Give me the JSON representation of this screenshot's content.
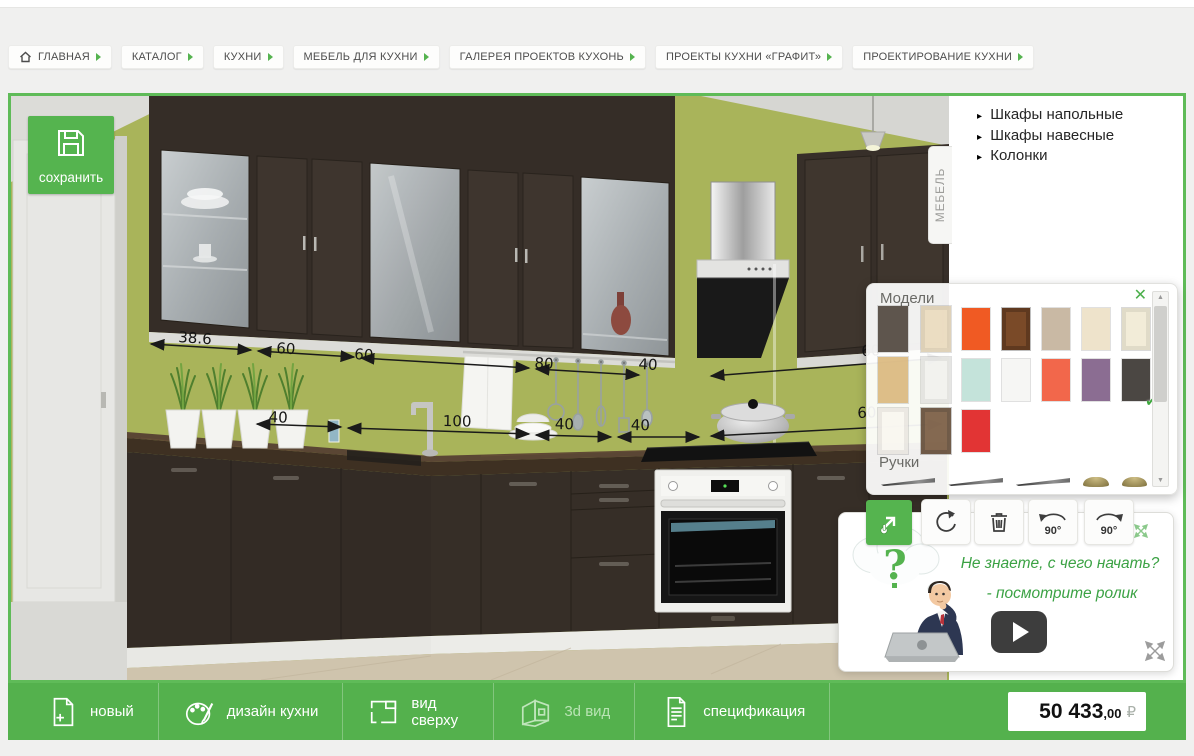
{
  "app": {
    "type": "kitchen-3d-planner"
  },
  "colors": {
    "accent_green": "#55b44f",
    "toolbar_green": "#54b14d",
    "wall_olive": "#a9b45a",
    "cabinet_dark": "#38302a",
    "help_text_green": "#3ba244"
  },
  "breadcrumbs": {
    "items": [
      {
        "label": "ГЛАВНАЯ",
        "home": true
      },
      {
        "label": "КАТАЛОГ"
      },
      {
        "label": "КУХНИ"
      },
      {
        "label": "МЕБЕЛЬ ДЛЯ КУХНИ"
      },
      {
        "label": "ГАЛЕРЕЯ ПРОЕКТОВ КУХОНЬ"
      },
      {
        "label": "ПРОЕКТЫ КУХНИ «ГРАФИТ»"
      },
      {
        "label": "ПРОЕКТИРОВАНИЕ КУХНИ"
      }
    ]
  },
  "save_button": {
    "label": "сохранить"
  },
  "furniture_tab": {
    "label": "МЕБЕЛЬ"
  },
  "catalog_menu": {
    "bullet": "▸",
    "items": [
      {
        "label": "Шкафы напольные"
      },
      {
        "label": "Шкафы навесные"
      },
      {
        "label": "Колонки"
      }
    ]
  },
  "scene": {
    "dimension_labels": [
      {
        "text": "38.6",
        "x": "168px",
        "y": "232px",
        "rot": "rotate(4deg)"
      },
      {
        "text": "60",
        "x": "266px",
        "y": "243px",
        "rot": "rotate(4deg)"
      },
      {
        "text": "60",
        "x": "344px",
        "y": "249px",
        "rot": "rotate(4deg)"
      },
      {
        "text": "80",
        "x": "524px",
        "y": "258px",
        "rot": "rotate(3deg)"
      },
      {
        "text": "40",
        "x": "628px",
        "y": "259px",
        "rot": "rotate(3deg)"
      },
      {
        "text": "60",
        "x": "850px",
        "y": "246px",
        "rot": "rotate(-2deg)"
      },
      {
        "text": "40",
        "x": "258px",
        "y": "312px",
        "rot": "rotate(2deg)"
      },
      {
        "text": "100",
        "x": "432px",
        "y": "316px",
        "rot": "rotate(1deg)"
      },
      {
        "text": "40",
        "x": "544px",
        "y": "319px",
        "rot": "rotate(1deg)"
      },
      {
        "text": "40",
        "x": "620px",
        "y": "320px",
        "rot": "rotate(1deg)"
      },
      {
        "text": "60",
        "x": "846px",
        "y": "308px",
        "rot": "rotate(-2deg)"
      }
    ]
  },
  "models_panel": {
    "title": "Модели",
    "handles_title": "Ручки",
    "close_icon": "✕",
    "scroll_up": "▲",
    "scroll_down": "▼",
    "selected_check": "✔",
    "thumbnails": [
      {
        "name": "front-dark-brown",
        "color": "#3f342a"
      },
      {
        "name": "front-cream-frame",
        "color": "#ead9b8",
        "cls": "tx-door-light"
      },
      {
        "name": "front-light-wood",
        "color": "#d8b271",
        "cls": "tx-wood"
      },
      {
        "name": "front-white",
        "color": "#f1f1ee",
        "cls": "tx-door-light"
      },
      {
        "name": "front-white-sketch",
        "color": "#faf7f0",
        "cls": "tx-door-light"
      },
      {
        "name": "front-brown-door",
        "color": "#6b4a2e",
        "cls": "tx-door"
      }
    ],
    "swatches": [
      {
        "name": "orange",
        "color": "#f05a23"
      },
      {
        "name": "brown-wood-door",
        "color": "#7a4a28",
        "cls": "tx-door"
      },
      {
        "name": "taupe",
        "color": "#c9b9a4"
      },
      {
        "name": "cream",
        "color": "#eee3cb"
      },
      {
        "name": "cream-panel-door",
        "color": "#f2ecd8",
        "cls": "tx-door-light"
      },
      {
        "name": "mint-planks",
        "color": "#c4e3da",
        "cls": "tx-stripes"
      },
      {
        "name": "white",
        "color": "#f6f6f4"
      },
      {
        "name": "coral",
        "color": "#f2674b"
      },
      {
        "name": "purple",
        "color": "#8b6d92"
      },
      {
        "name": "graphite",
        "color": "#4b4743",
        "selected": true
      },
      {
        "name": "red",
        "color": "#e23434"
      }
    ],
    "handles": [
      {
        "name": "long-handle",
        "cls": "handle-long"
      },
      {
        "name": "long-handle",
        "cls": "handle-long"
      },
      {
        "name": "long-handle",
        "cls": "handle-long"
      },
      {
        "name": "knob",
        "cls": "knob-gold"
      },
      {
        "name": "knob",
        "cls": "knob-gold"
      }
    ]
  },
  "tools": {
    "rotate_left_label": "90°",
    "rotate_right_label": "90°"
  },
  "help": {
    "line1": "Не знаете, с чего начать?",
    "line2": "- посмотрите ролик"
  },
  "bottom_bar": {
    "items": [
      {
        "label": "новый"
      },
      {
        "label": "дизайн кухни"
      },
      {
        "label": "вид сверху"
      },
      {
        "label": "3d вид",
        "active": true
      },
      {
        "label": "спецификация"
      }
    ],
    "price": {
      "amount": "50 433",
      "fraction": ",00",
      "currency": "₽"
    }
  }
}
